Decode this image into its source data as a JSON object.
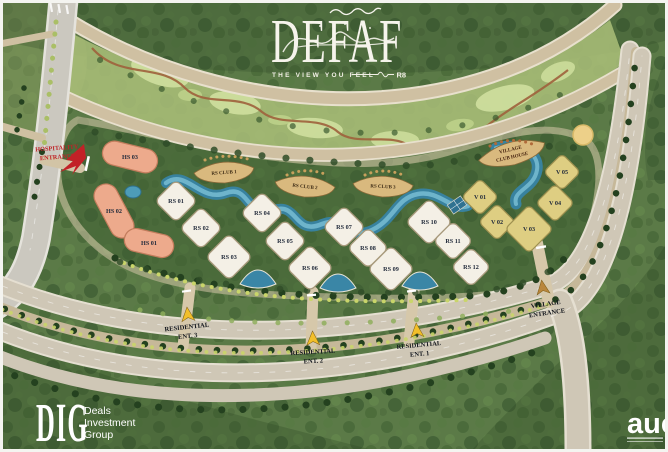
{
  "title": {
    "name": "DEFAF",
    "tagline": "THE VIEW YOU FEEL",
    "badge": "R8"
  },
  "map": {
    "hospitality_entrance": {
      "line1": "HOSPITALITY",
      "line2": "ENTRANCE"
    },
    "hospitality_buildings": [
      {
        "id": "HS 03",
        "x": 130,
        "y": 157,
        "w": 56,
        "h": 24,
        "rot": 14
      },
      {
        "id": "HS 02",
        "x": 114,
        "y": 211,
        "w": 58,
        "h": 24,
        "rot": 62
      },
      {
        "id": "HS 01",
        "x": 149,
        "y": 243,
        "w": 50,
        "h": 23,
        "rot": 13
      }
    ],
    "residential_buildings": [
      {
        "id": "RS 01",
        "x": 176,
        "y": 201,
        "s": 30
      },
      {
        "id": "RS 02",
        "x": 201,
        "y": 228,
        "s": 30
      },
      {
        "id": "RS 03",
        "x": 229,
        "y": 257,
        "s": 33
      },
      {
        "id": "RS 04",
        "x": 262,
        "y": 213,
        "s": 30
      },
      {
        "id": "RS 05",
        "x": 285,
        "y": 241,
        "s": 30
      },
      {
        "id": "RS 06",
        "x": 310,
        "y": 268,
        "s": 33
      },
      {
        "id": "RS 07",
        "x": 344,
        "y": 227,
        "s": 30
      },
      {
        "id": "RS 08",
        "x": 368,
        "y": 248,
        "s": 29
      },
      {
        "id": "RS 09",
        "x": 391,
        "y": 269,
        "s": 33
      },
      {
        "id": "RS 10",
        "x": 429,
        "y": 222,
        "s": 33
      },
      {
        "id": "RS 11",
        "x": 453,
        "y": 241,
        "s": 28
      },
      {
        "id": "RS 12",
        "x": 471,
        "y": 267,
        "s": 28
      }
    ],
    "clubs": [
      {
        "id": "RS CLUB 1",
        "x": 224,
        "y": 172,
        "rot": -4
      },
      {
        "id": "RS CLUB 2",
        "x": 305,
        "y": 186,
        "rot": 6
      },
      {
        "id": "RS CLUB 3",
        "x": 383,
        "y": 186,
        "rot": 3
      }
    ],
    "villa_buildings": [
      {
        "id": "V 01",
        "x": 480,
        "y": 197,
        "s": 26
      },
      {
        "id": "V 02",
        "x": 497,
        "y": 222,
        "s": 26
      },
      {
        "id": "V 03",
        "x": 529,
        "y": 229,
        "s": 34
      },
      {
        "id": "V 04",
        "x": 555,
        "y": 203,
        "s": 27
      },
      {
        "id": "V 05",
        "x": 562,
        "y": 172,
        "s": 26
      }
    ],
    "village_clubhouse": {
      "line1": "VILLAGE",
      "line2": "CLUB HOUSE"
    },
    "residential_entrances": [
      {
        "line1": "RESIDENTIAL",
        "line2": "ENT. 3",
        "lx": 187,
        "ly": 329,
        "ax": 188,
        "ay": 317,
        "rot": -6
      },
      {
        "line1": "RESIDENTIAL",
        "line2": "ENT. 2",
        "lx": 313,
        "ly": 354,
        "ax": 313,
        "ay": 341,
        "rot": -3
      },
      {
        "line1": "RESIDENTIAL",
        "line2": "ENT. 1",
        "lx": 419,
        "ly": 347,
        "ax": 417,
        "ay": 333,
        "rot": -5
      }
    ],
    "village_entrance": {
      "line1": "VILLAGE",
      "line2": "ENTRANCE",
      "lx": 546,
      "ly": 306,
      "ax": 543,
      "ay": 290,
      "rot": -8
    },
    "colors": {
      "water": "#3a86a6",
      "road_tan": "#cfc0a2",
      "rs_fill": "#f4f0e6",
      "villa_fill": "#dece82",
      "hs_fill": "#edaa8c",
      "club_fill": "#d9b97e",
      "entrance_arrow": "#f2bf2a",
      "village_arrow": "#b9863c",
      "entrance_text_red": "#bf2429"
    }
  },
  "footer": {
    "dig_abbr": "DIG",
    "dig_lines": [
      "Deals",
      "Investment",
      "Group"
    ],
    "aue_abbr": "aue"
  }
}
